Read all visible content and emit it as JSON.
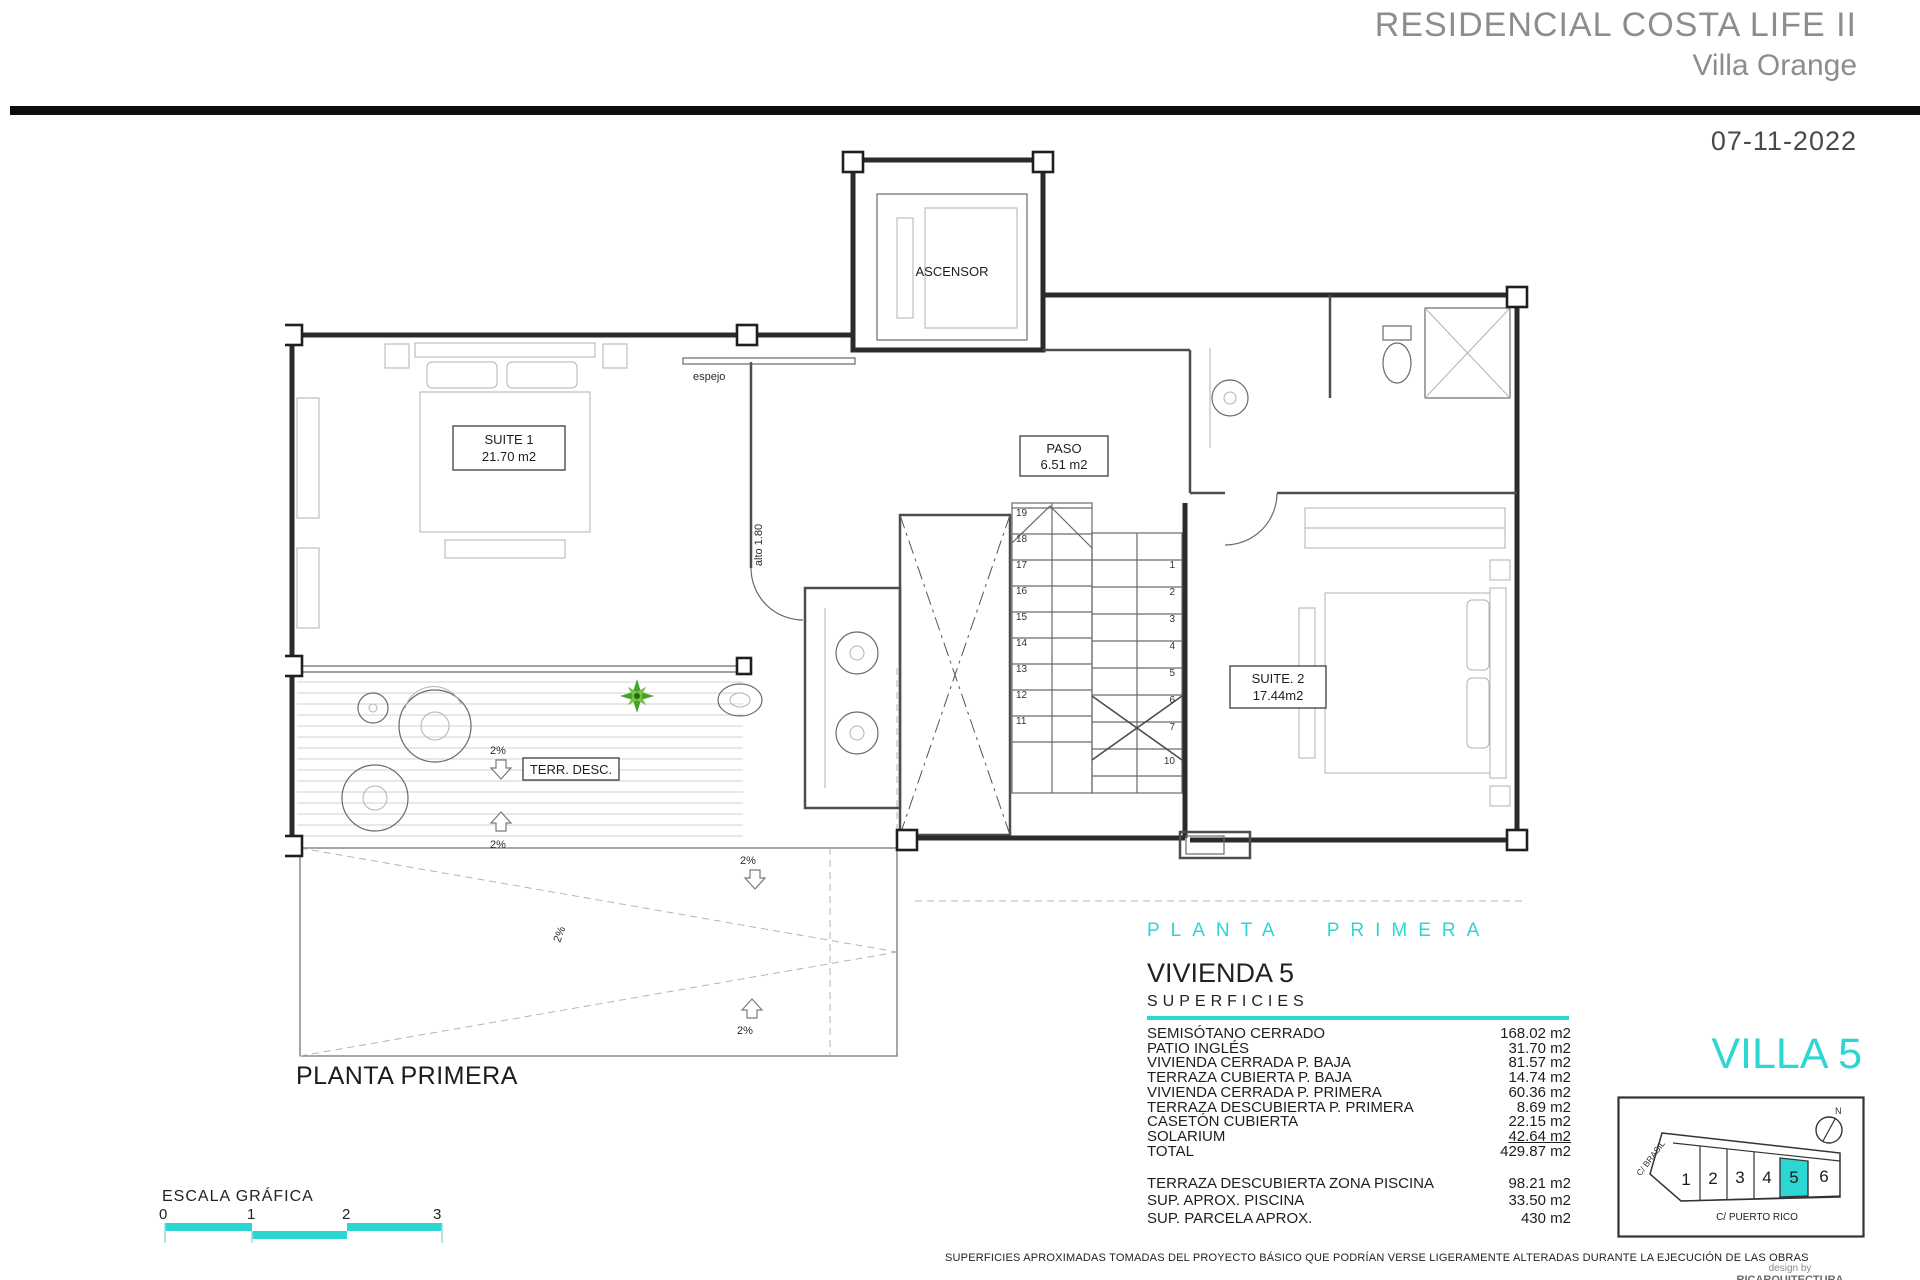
{
  "header": {
    "project_title": "RESIDENCIAL COSTA LIFE II",
    "project_subtitle": "Villa Orange",
    "date": "07-11-2022"
  },
  "plan": {
    "caption": "PLANTA PRIMERA",
    "labels": {
      "ascensor": "ASCENSOR",
      "espejo": "espejo",
      "alto": "alto 1.80",
      "suite1_name": "SUITE 1",
      "suite1_area": "21.70 m2",
      "paso_name": "PASO",
      "paso_area": "6.51 m2",
      "suite2_name": "SUITE. 2",
      "suite2_area": "17.44m2",
      "terraza": "TERR. DESC.",
      "slope": "2%"
    },
    "stairs": {
      "left_flight": [
        "19",
        "18",
        "17",
        "16",
        "15",
        "14",
        "13",
        "12",
        "11"
      ],
      "right_flight": [
        "1",
        "2",
        "3",
        "4",
        "5",
        "6",
        "7",
        "10"
      ]
    }
  },
  "summary": {
    "floor_heading": "PLANTA PRIMERA",
    "unit": "VIVIENDA 5",
    "section_title": "SUPERFICIES",
    "rows": [
      {
        "label": "SEMISÓTANO CERRADO",
        "value": "168.02 m2"
      },
      {
        "label": "PATIO INGLÉS",
        "value": "31.70 m2"
      },
      {
        "label": "VIVIENDA CERRADA P. BAJA",
        "value": "81.57 m2"
      },
      {
        "label": "TERRAZA CUBIERTA P. BAJA",
        "value": "14.74 m2"
      },
      {
        "label": "VIVIENDA CERRADA P. PRIMERA",
        "value": "60.36 m2"
      },
      {
        "label": "TERRAZA DESCUBIERTA P. PRIMERA",
        "value": "8.69 m2"
      },
      {
        "label": "CASETÓN CUBIERTA",
        "value": "22.15 m2"
      },
      {
        "label": "SOLARIUM",
        "value": "42.64 m2"
      },
      {
        "label": "TOTAL",
        "value": "429.87 m2"
      }
    ],
    "extra_rows": [
      {
        "label": "TERRAZA DESCUBIERTA  ZONA PISCINA",
        "value": "98.21 m2"
      },
      {
        "label": "SUP.  APROX.  PISCINA",
        "value": "33.50 m2"
      },
      {
        "label": "SUP. PARCELA APROX.",
        "value": "430 m2"
      }
    ]
  },
  "site": {
    "title": "VILLA 5",
    "compass": "N",
    "street_left": "C/ BRASIL",
    "street_bottom": "C/ PUERTO RICO",
    "plots": [
      "1",
      "2",
      "3",
      "4",
      "5",
      "6"
    ],
    "highlighted_plot": "5"
  },
  "scale_bar": {
    "label": "ESCALA GRÁFICA",
    "ticks": [
      "0",
      "1",
      "2",
      "3"
    ]
  },
  "footer": {
    "disclaimer": "SUPERFICIES APROXIMADAS TOMADAS DEL PROYECTO BÁSICO QUE PODRÍAN VERSE LIGERAMENTE ALTERADAS DURANTE LA EJECUCIÓN DE LAS OBRAS",
    "design_by": "design by",
    "studio": "RICARQUITECTURA"
  },
  "colors": {
    "accent_cyan": "#2BD6D3",
    "header_gray": "#8D8D8D",
    "bar_black": "#0D0D0D",
    "wall_dark": "#2B2B2B",
    "plant_green": "#45A32A"
  }
}
